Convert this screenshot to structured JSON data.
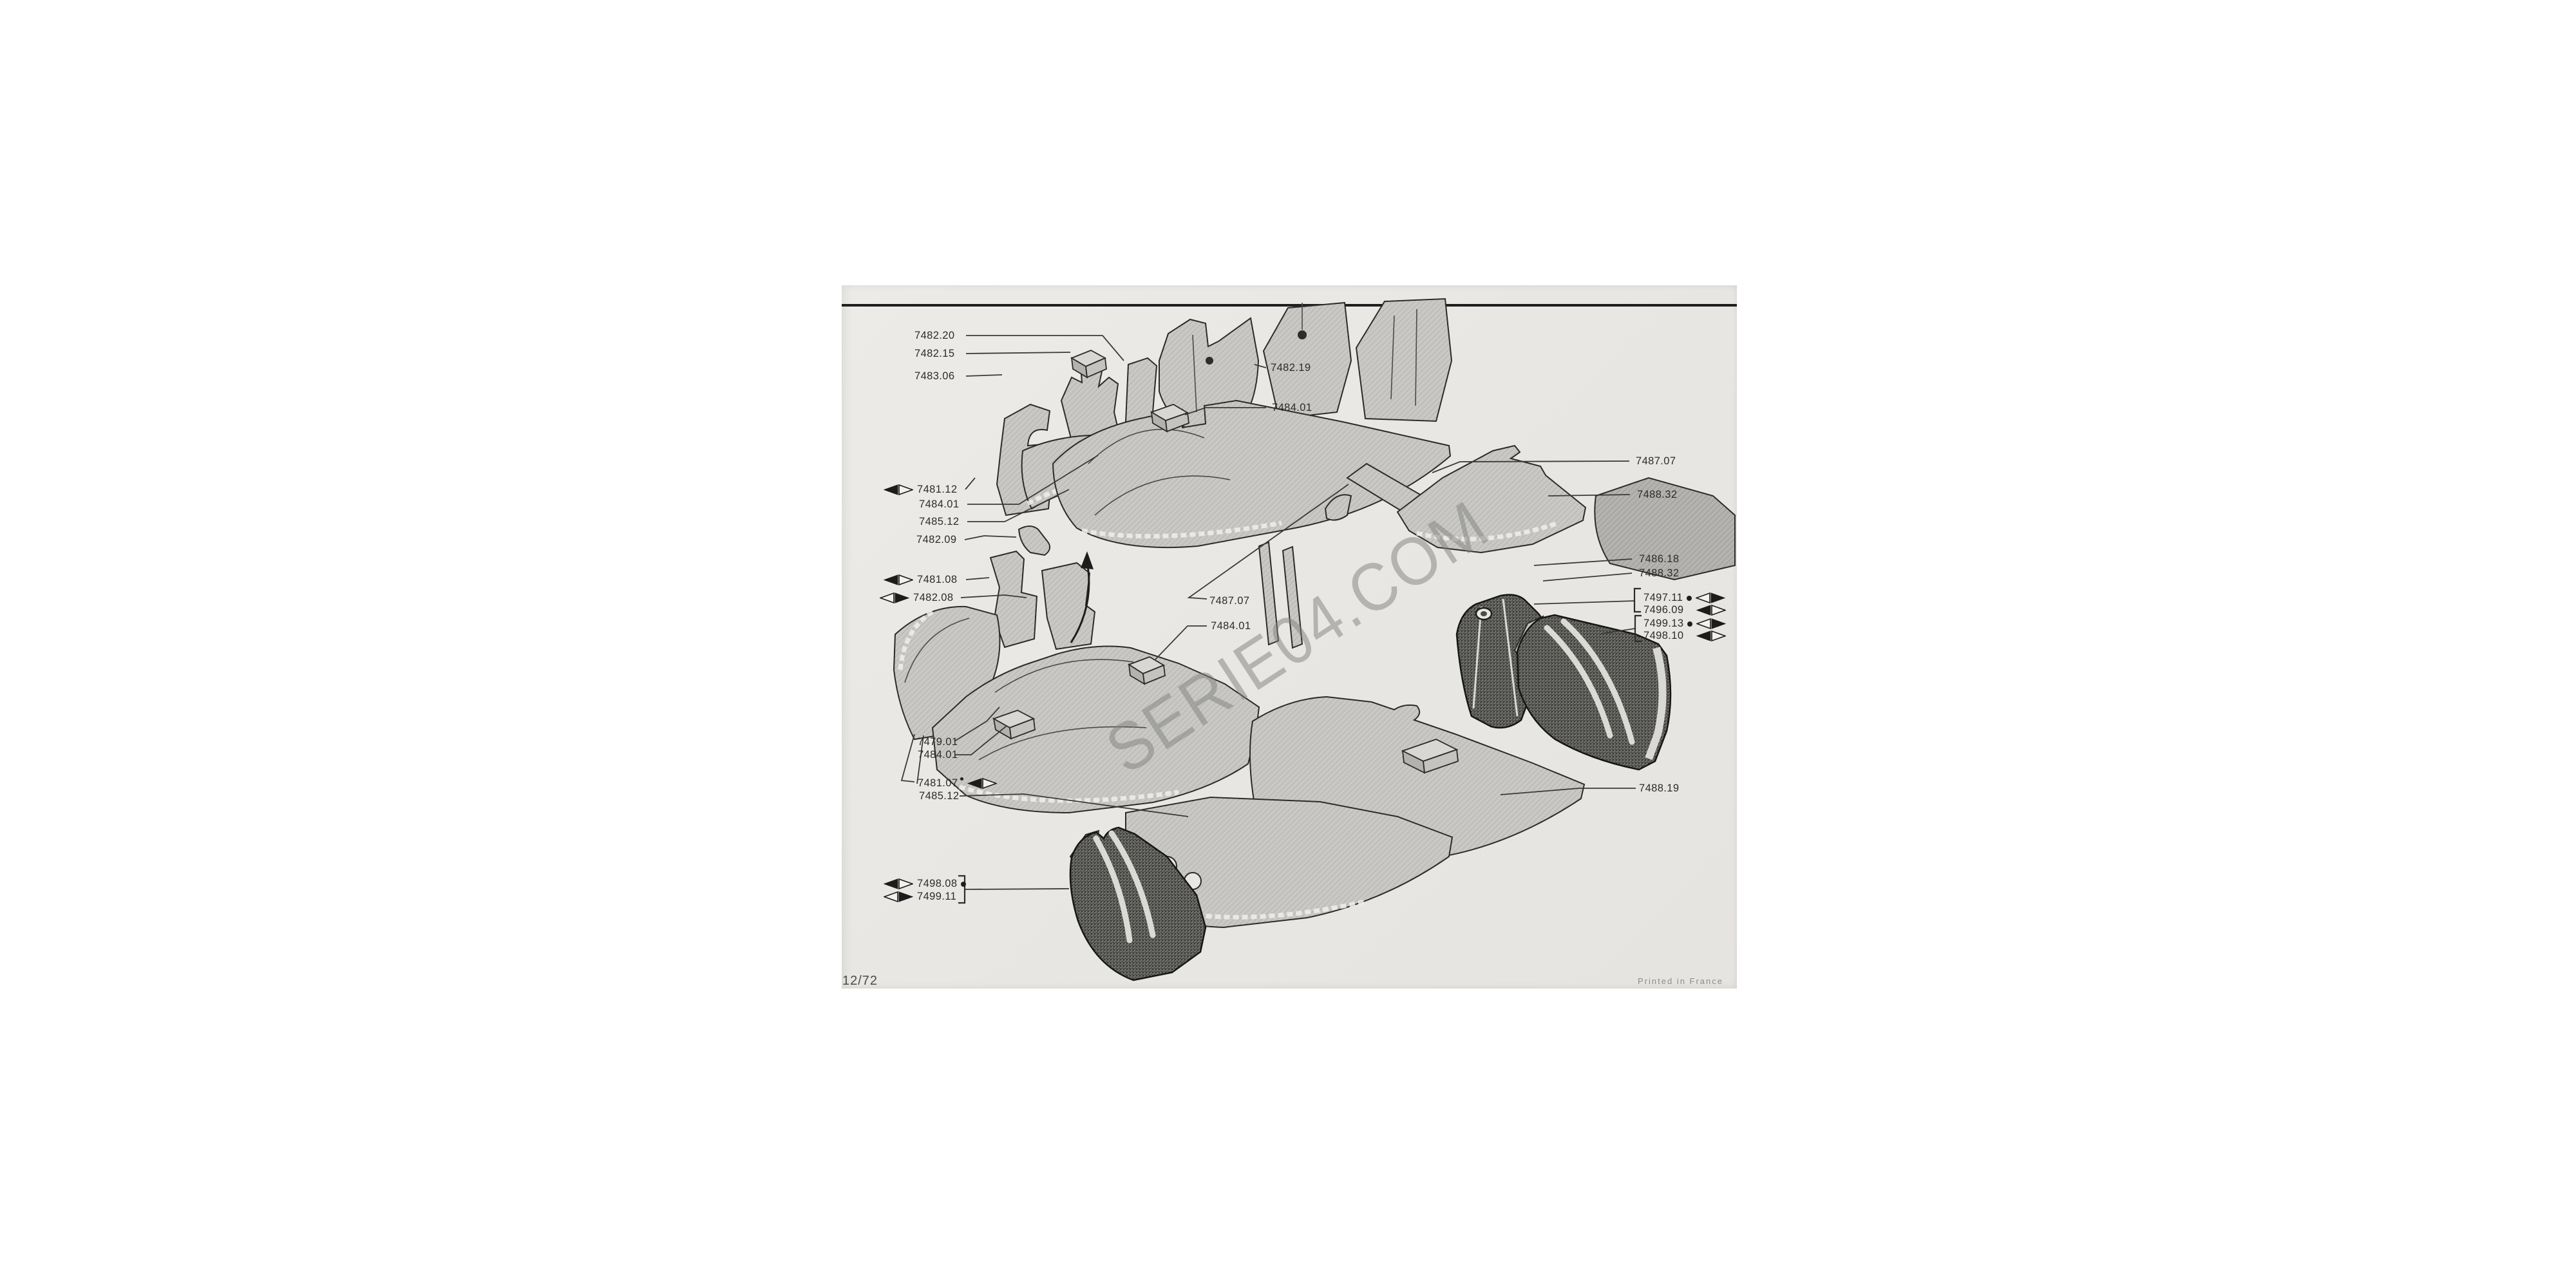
{
  "page": {
    "sheet_number": "12/72",
    "printed_note": "Printed in France",
    "watermark": "SERIE04.COM"
  },
  "labels": [
    {
      "text": "7482.20"
    },
    {
      "text": "7482.15"
    },
    {
      "text": "7483.06"
    },
    {
      "text": "7482.19"
    },
    {
      "text": "7484.01"
    },
    {
      "text": "7481.12",
      "arrow": "left"
    },
    {
      "text": "7484.01"
    },
    {
      "text": "7485.12"
    },
    {
      "text": "7482.09"
    },
    {
      "text": "7481.08",
      "arrow": "left"
    },
    {
      "text": "7482.08",
      "arrow": "right"
    },
    {
      "text": "7487.07"
    },
    {
      "text": "7488.32"
    },
    {
      "text": "7486.18"
    },
    {
      "text": "7488.32"
    },
    {
      "text": "7497.11",
      "arrow": "right",
      "dot": true
    },
    {
      "text": "7496.09",
      "arrow": "left"
    },
    {
      "text": "7499.13",
      "arrow": "right",
      "dot": true
    },
    {
      "text": "7498.10",
      "arrow": "left"
    },
    {
      "text": "7487.07"
    },
    {
      "text": "7484.01"
    },
    {
      "text": "7479.01"
    },
    {
      "text": "7484.01"
    },
    {
      "text": "7481.07",
      "arrow": "left",
      "dot_sup": true
    },
    {
      "text": "7485.12"
    },
    {
      "text": "7488.19"
    },
    {
      "text": "7498.08",
      "arrow": "left",
      "dot": true
    },
    {
      "text": "7499.11",
      "arrow": "right"
    }
  ]
}
